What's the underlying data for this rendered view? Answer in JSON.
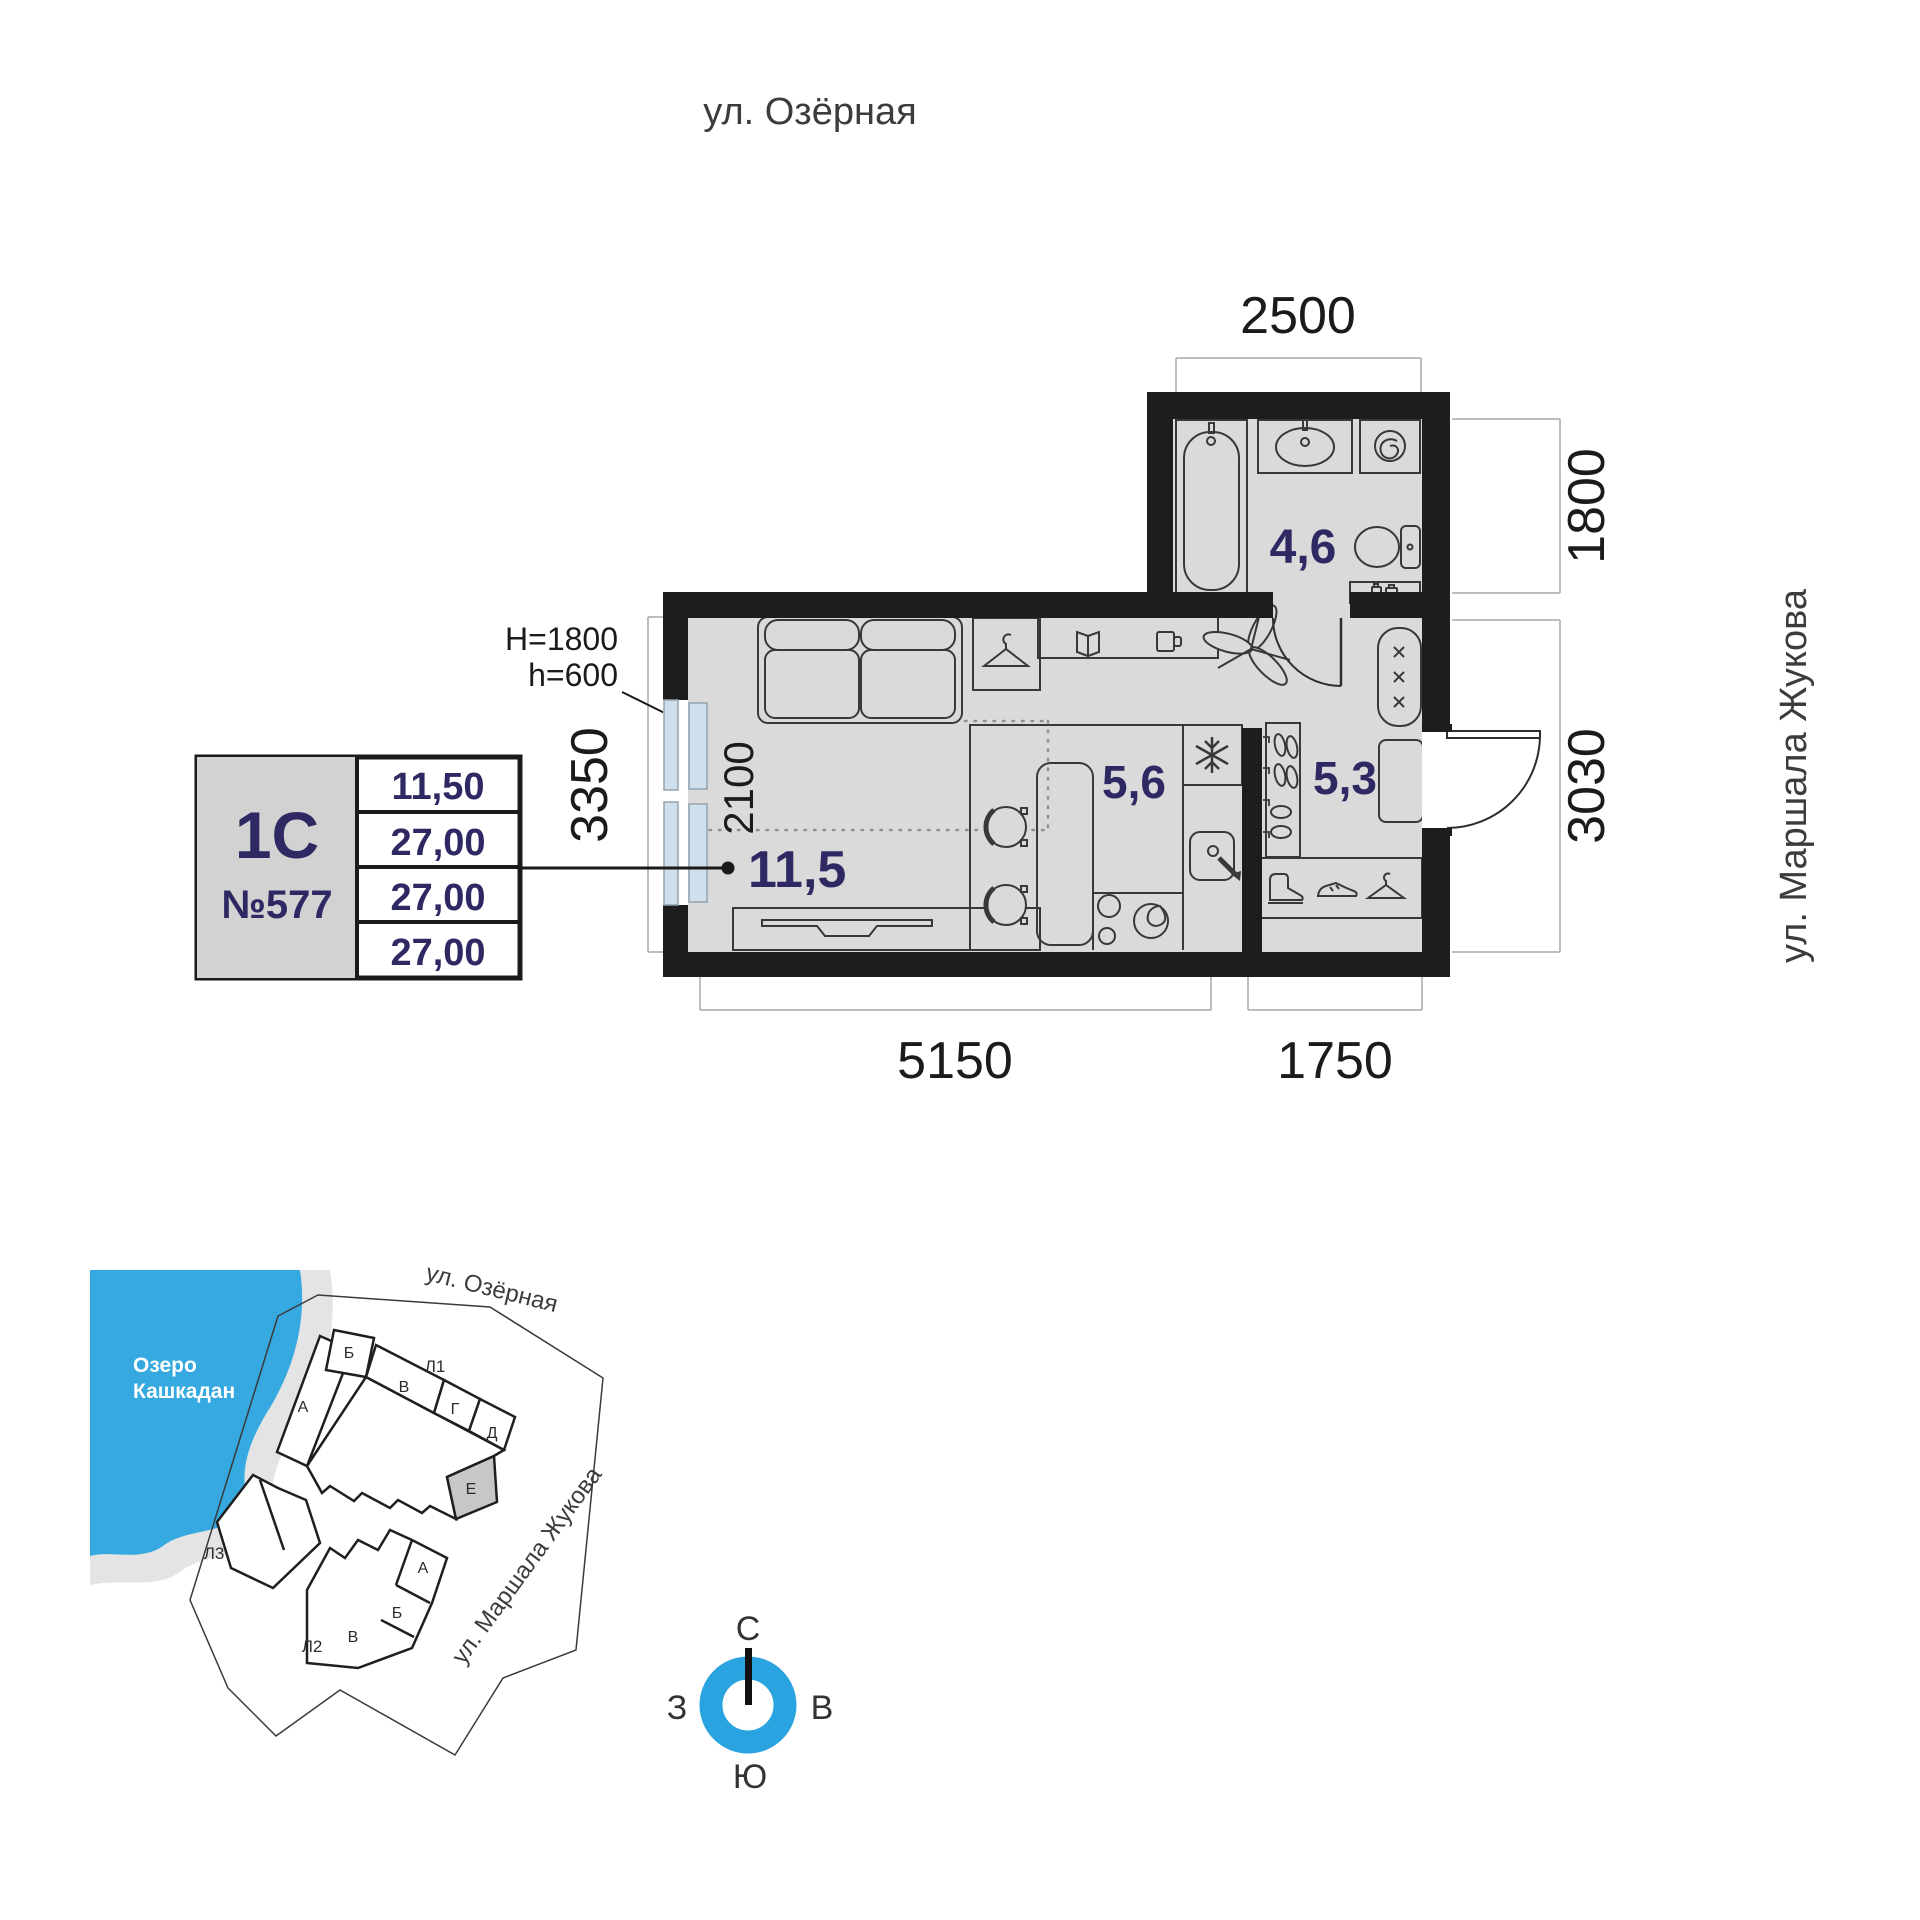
{
  "streets": {
    "top": "ул. Озёрная",
    "right": "ул. Маршала Жукова"
  },
  "floor_plan": {
    "dim_top": "2500",
    "dim_right_top": "1800",
    "dim_right_bottom": "3030",
    "dim_left": "3350",
    "dim_bottom_left": "5150",
    "dim_bottom_right": "1750",
    "dim_bed_zone": "2100",
    "note_window_H": "H=1800",
    "note_window_h": "h=600",
    "area_living": "11,5",
    "area_kitchen": "5,6",
    "area_hall": "5,3",
    "area_bath": "4,6"
  },
  "unit_card": {
    "type": "1С",
    "number": "№577",
    "values": [
      "11,50",
      "27,00",
      "27,00",
      "27,00"
    ]
  },
  "site": {
    "lake1": "Озеро",
    "lake2": "Кашкадан",
    "street_top": "ул. Озёрная",
    "street_right": "ул. Маршала Жукова",
    "b1": "Л1",
    "b2": "Л2",
    "b3": "Л3",
    "s_a": "А",
    "s_b": "Б",
    "s_v": "В",
    "s_g": "Г",
    "s_d": "Д",
    "s_e": "Е",
    "s2_a": "А",
    "s2_b": "Б",
    "s2_v": "В"
  },
  "compass": {
    "n": "С",
    "e": "В",
    "s": "Ю",
    "w": "З"
  },
  "colors": {
    "accent_blue": "#36a9e1",
    "compass_blue": "#2aa4e0",
    "navy": "#2e2963",
    "wall": "#1d1d1d",
    "floor": "#dadada",
    "window": "#cfdfeb",
    "highlight_section": "#c7c7c7"
  }
}
